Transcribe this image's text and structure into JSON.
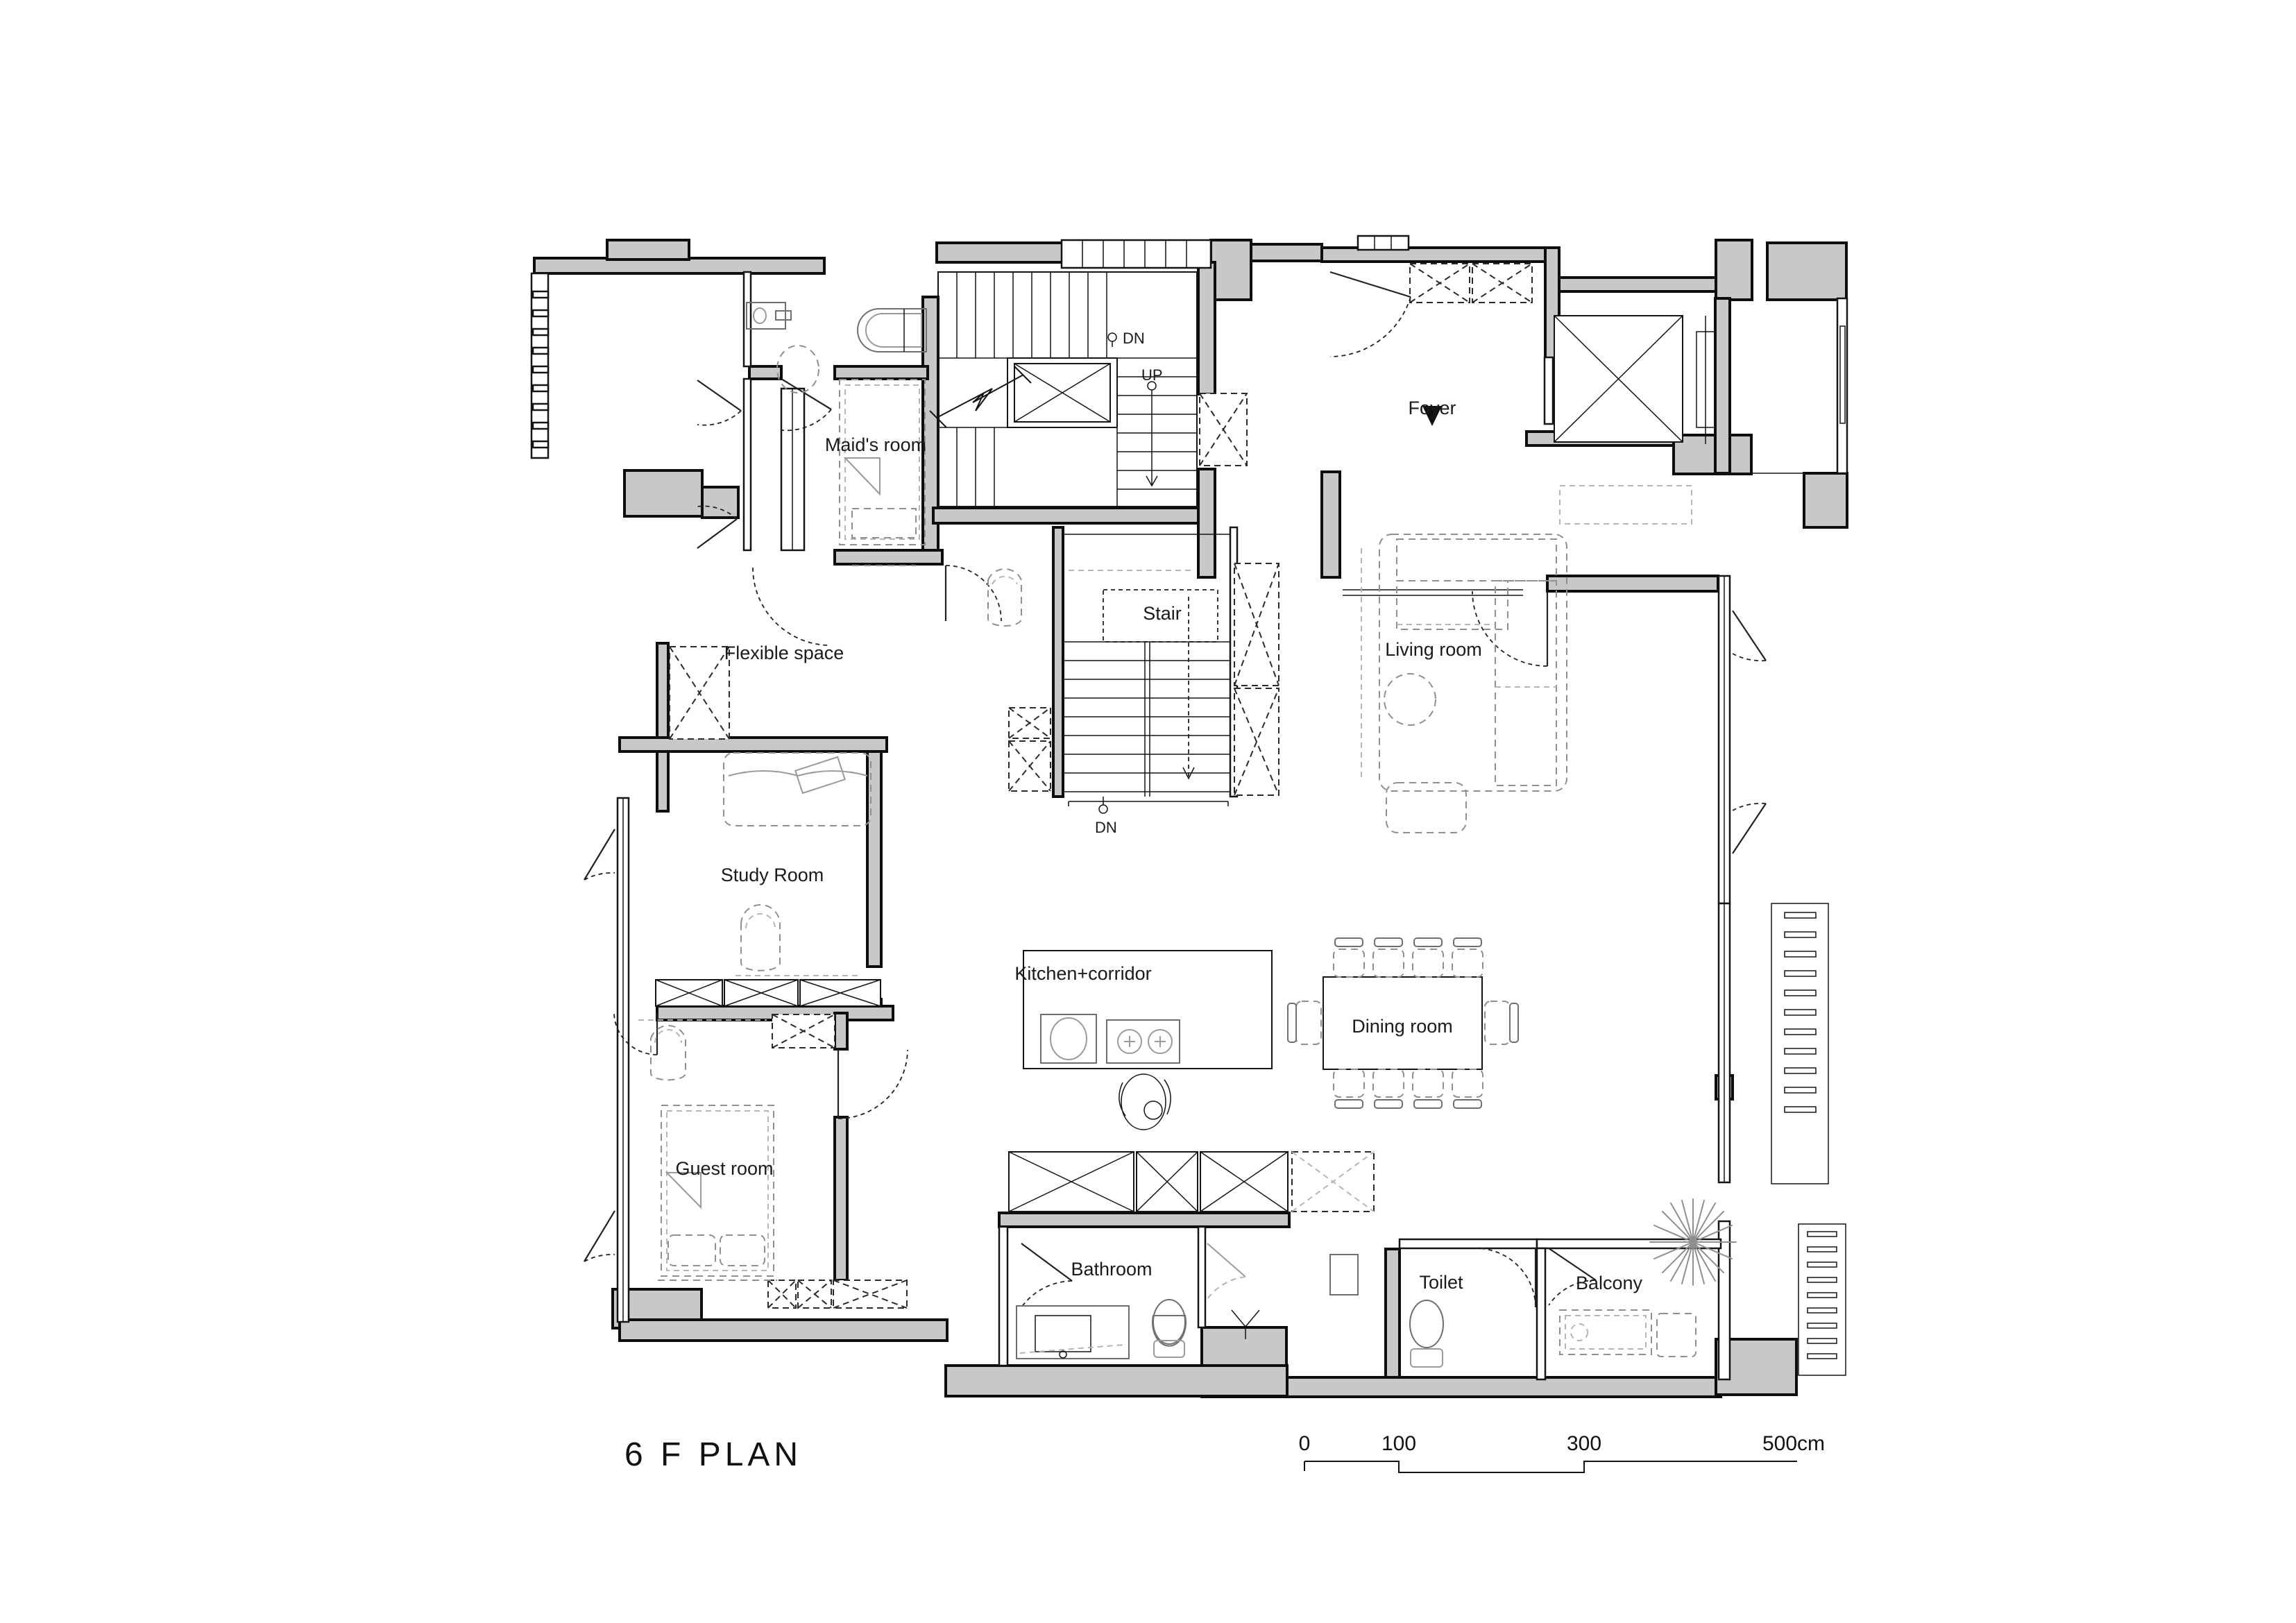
{
  "title": "6 F  PLAN",
  "rooms": {
    "maid": {
      "label": "Maid's room"
    },
    "foyer": {
      "label": "Foyer"
    },
    "stair": {
      "label": "Stair"
    },
    "flexible": {
      "label": "Flexible space"
    },
    "living": {
      "label": "Living  room"
    },
    "study": {
      "label": "Study Room"
    },
    "kitchen": {
      "label": "Kitchen+corridor"
    },
    "dining": {
      "label": "Dining room"
    },
    "guest": {
      "label": "Guest room"
    },
    "bathroom": {
      "label": "Bathroom"
    },
    "toilet": {
      "label": "Toilet"
    },
    "balcony": {
      "label": "Balcony"
    }
  },
  "annotations": {
    "dn_upper": "DN",
    "up": "UP",
    "dn_lower": "DN"
  },
  "scale_bar": {
    "t0": "0",
    "t1": "100",
    "t2": "300",
    "t3": "500cm"
  },
  "colors": {
    "wall_fill": "#c8c8c8",
    "line": "#141414",
    "furniture": "#8f8f8f"
  }
}
